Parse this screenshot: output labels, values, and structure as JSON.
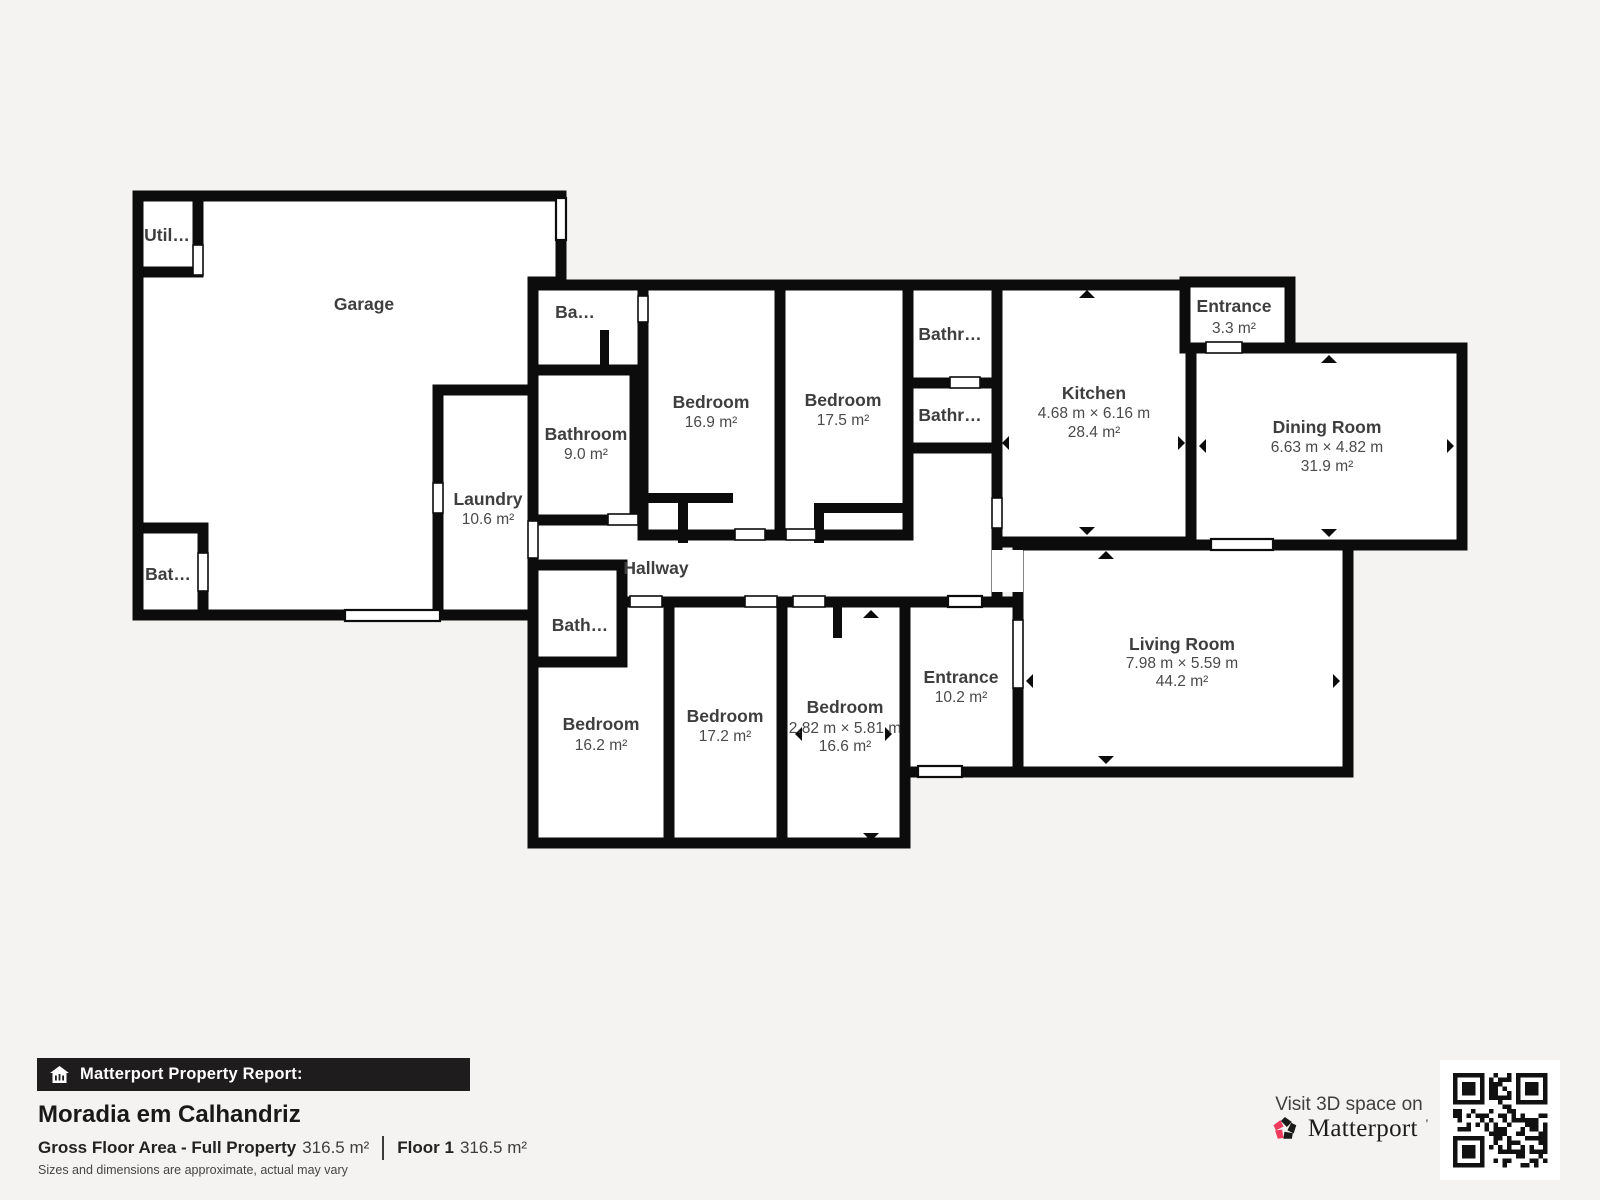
{
  "colors": {
    "background": "#f4f3f1",
    "wall": "#0c0c0c",
    "room_fill": "#ffffff",
    "label": "#3e3e3e",
    "bar_background": "#1e1c1c",
    "accent_pink": "#ef3a5d"
  },
  "floorplan": {
    "rooms": [
      {
        "id": "garage",
        "name": "Garage"
      },
      {
        "id": "utility",
        "name": "Util…"
      },
      {
        "id": "bathroom-left",
        "name": "Bat…"
      },
      {
        "id": "laundry",
        "name": "Laundry",
        "area": "10.6 m²"
      },
      {
        "id": "bathroom-top",
        "name": "Ba…"
      },
      {
        "id": "bathroom-9",
        "name": "Bathroom",
        "area": "9.0 m²"
      },
      {
        "id": "bedroom-169",
        "name": "Bedroom",
        "area": "16.9 m²"
      },
      {
        "id": "bedroom-175",
        "name": "Bedroom",
        "area": "17.5 m²"
      },
      {
        "id": "bathroom-small-1",
        "name": "Bathr…"
      },
      {
        "id": "bathroom-small-2",
        "name": "Bathr…"
      },
      {
        "id": "kitchen",
        "name": "Kitchen",
        "dims": "4.68 m × 6.16 m",
        "area": "28.4 m²"
      },
      {
        "id": "entrance-33",
        "name": "Entrance",
        "area": "3.3 m²"
      },
      {
        "id": "dining-room",
        "name": "Dining Room",
        "dims": "6.63 m × 4.82 m",
        "area": "31.9 m²"
      },
      {
        "id": "hallway",
        "name": "Hallway"
      },
      {
        "id": "bathroom-bottom",
        "name": "Bath…"
      },
      {
        "id": "bedroom-162",
        "name": "Bedroom",
        "area": "16.2 m²"
      },
      {
        "id": "bedroom-172",
        "name": "Bedroom",
        "area": "17.2 m²"
      },
      {
        "id": "bedroom-166",
        "name": "Bedroom",
        "dims": "2.82 m × 5.81 m",
        "area": "16.6 m²"
      },
      {
        "id": "entrance-102",
        "name": "Entrance",
        "area": "10.2 m²"
      },
      {
        "id": "living-room",
        "name": "Living Room",
        "dims": "7.98 m × 5.59 m",
        "area": "44.2 m²"
      }
    ]
  },
  "report": {
    "header": "Matterport Property Report:",
    "title": "Moradia em Calhandriz",
    "gross_label": "Gross Floor Area - Full Property",
    "gross_value": "316.5 m²",
    "floor_label": "Floor 1",
    "floor_value": "316.5 m²",
    "disclaimer": "Sizes and dimensions are approximate, actual may vary"
  },
  "promo": {
    "visit_text": "Visit 3D space on",
    "brand": "Matterport",
    "trademark": "'"
  },
  "icons": {
    "report_bar": "house-icon",
    "brand_logo": "matterport-pinwheel-icon",
    "qr": "qr-code"
  }
}
